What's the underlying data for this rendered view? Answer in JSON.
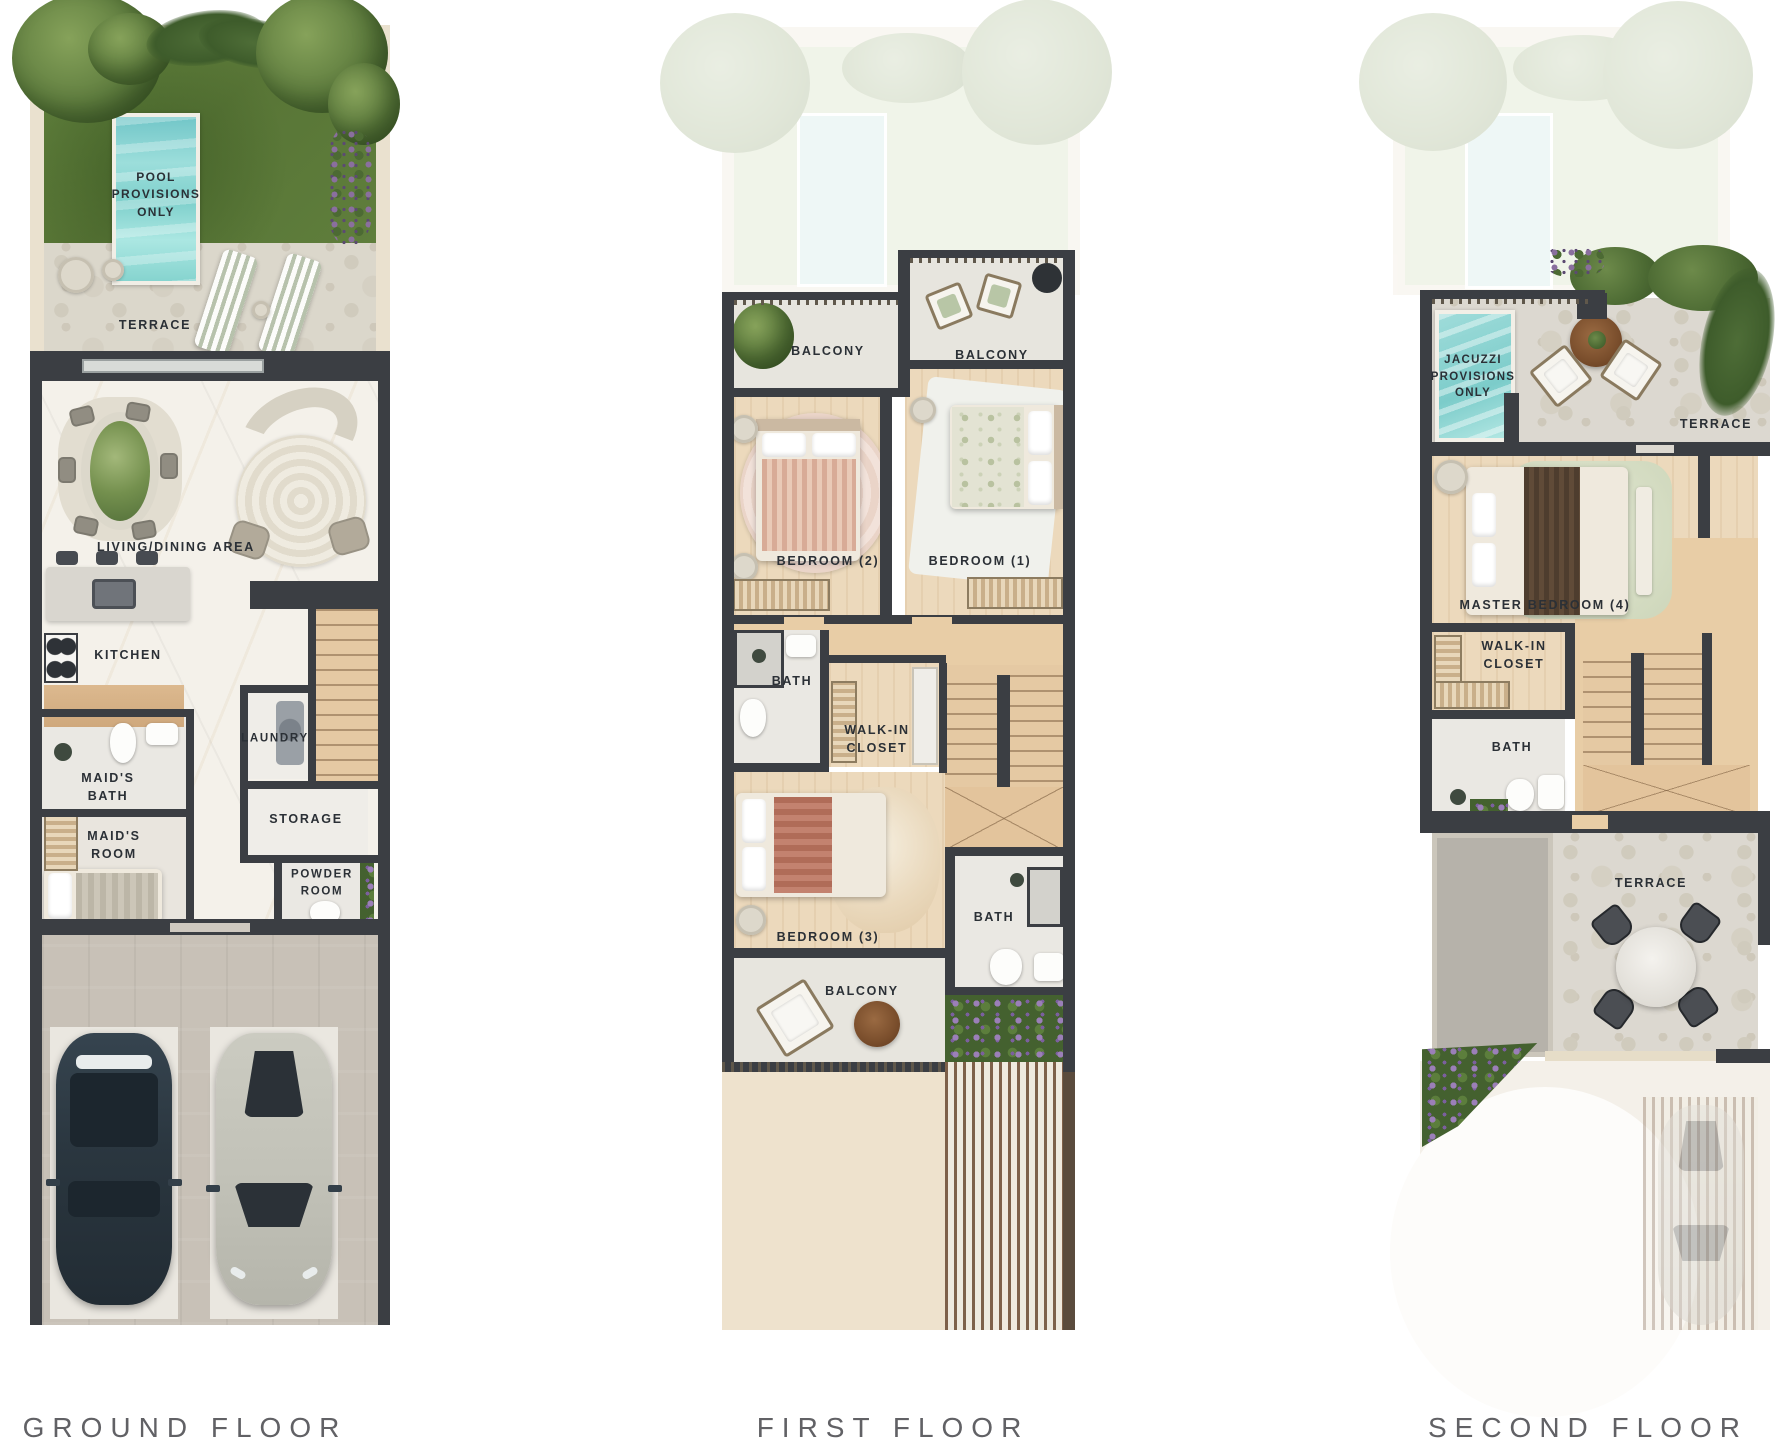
{
  "document": {
    "type": "residential floor plans",
    "background": "#ffffff"
  },
  "floors": {
    "ground": {
      "title": "GROUND FLOOR",
      "labels": {
        "pool": "POOL PROVISIONS ONLY",
        "terrace": "TERRACE",
        "living_dining": "LIVING/DINING AREA",
        "kitchen": "KITCHEN",
        "laundry": "LAUNDRY",
        "maids_bath": "MAID'S BATH",
        "maids_room": "MAID'S ROOM",
        "storage": "STORAGE",
        "powder_room": "POWDER ROOM"
      }
    },
    "first": {
      "title": "FIRST FLOOR",
      "labels": {
        "balcony_left": "BALCONY",
        "balcony_right": "BALCONY",
        "bedroom_2": "BEDROOM (2)",
        "bedroom_1": "BEDROOM (1)",
        "bath": "BATH",
        "walk_in_closet": "WALK-IN CLOSET",
        "bedroom_3": "BEDROOM (3)",
        "bath_2": "BATH",
        "balcony_rear": "BALCONY"
      }
    },
    "second": {
      "title": "SECOND FLOOR",
      "labels": {
        "jacuzzi": "JACUZZI PROVISIONS ONLY",
        "terrace_front": "TERRACE",
        "master_bedroom": "MASTER BEDROOM (4)",
        "walk_in_closet": "WALK-IN CLOSET",
        "bath": "BATH",
        "terrace_rear": "TERRACE"
      }
    }
  },
  "colors": {
    "wall": "#3b3e43",
    "grass": "#5e7c3e",
    "pool_water": "#8fd4d1",
    "wood_floor": "#ecd9bc",
    "marble_floor": "#f4f1ea",
    "stone_terrace": "#dbd7cb",
    "garage_floor": "#c8c1b7",
    "label_text": "#2b3036",
    "floor_title_text": "#616165"
  }
}
